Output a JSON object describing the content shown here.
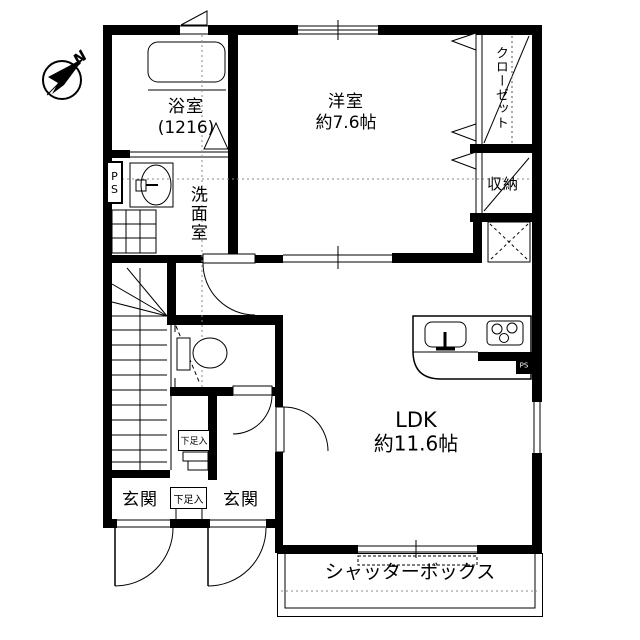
{
  "compass": {
    "north_label": "N"
  },
  "rooms": {
    "bathroom": {
      "name": "浴室",
      "size": "(1216)"
    },
    "washroom": {
      "name": "洗面室"
    },
    "western_room": {
      "name": "洋室",
      "size": "約7.6帖"
    },
    "closet": {
      "name": "クローゼット"
    },
    "storage": {
      "name": "収納"
    },
    "ldk": {
      "name": "LDK",
      "size": "約11.6帖"
    },
    "entrance_left": {
      "name": "玄関"
    },
    "entrance_right": {
      "name": "玄関"
    },
    "shoe_cabinet_upper": {
      "name": "下足入"
    },
    "shoe_cabinet_lower": {
      "name": "下足入"
    },
    "shutter_box": {
      "name": "シャッターボックス"
    },
    "pipe_space_left": {
      "name": "PS"
    },
    "pipe_space_right": {
      "name": "PS"
    }
  },
  "colors": {
    "wall": "#000000",
    "background": "#ffffff",
    "grid_line": "#8a8a8a"
  }
}
